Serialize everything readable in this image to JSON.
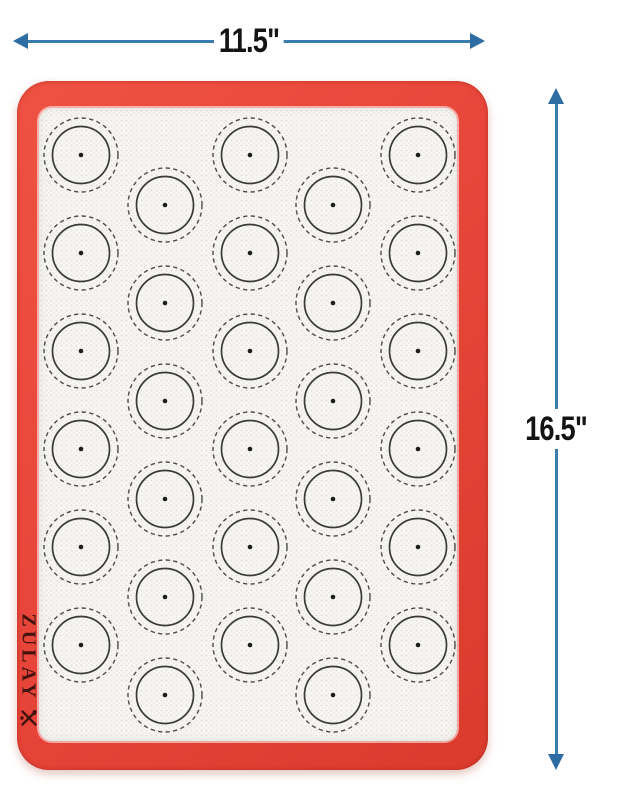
{
  "dimensions": {
    "width_label": "11.5\"",
    "height_label": "16.5\""
  },
  "mat": {
    "brand": "ZULAY",
    "logo_icon": "crossed-utensils",
    "circle_grid": {
      "odd_columns_x": [
        81,
        250,
        418
      ],
      "even_columns_x": [
        165,
        333
      ],
      "odd_rows_y": [
        155,
        253,
        351,
        449,
        547,
        645
      ],
      "even_rows_y": [
        205,
        303,
        401,
        499,
        597,
        695
      ],
      "dashed_radius": 37,
      "solid_radius": 28.5,
      "dot_radius": 2.3,
      "circle_count": 30
    }
  },
  "colors": {
    "arrow_blue": "#3a7cae",
    "arrow_head_blue": "#2d6da3",
    "mat_red": "#e8463a",
    "mat_red_dark": "#da3b2d",
    "mesh_white": "#f7f6f3",
    "circle_solid_stroke": "#3a3a3a",
    "circle_dashed_stroke": "#4c4c4c",
    "circle_dot": "#1d1d1d",
    "label_black": "#141414",
    "logo_maroon": "#44130e"
  }
}
